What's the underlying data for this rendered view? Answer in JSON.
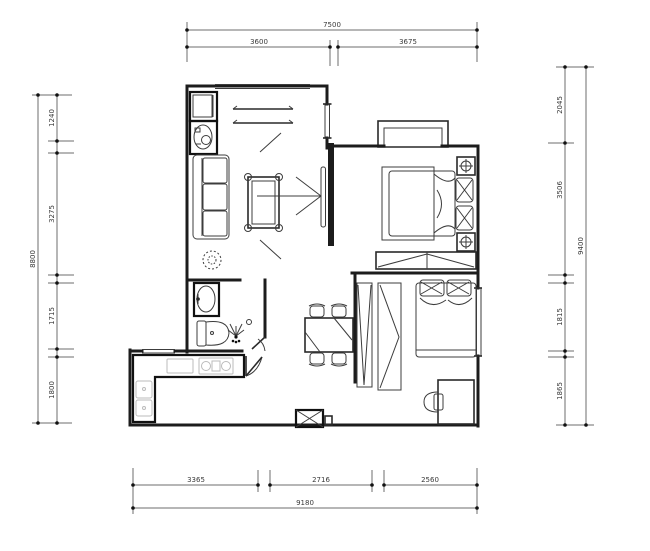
{
  "title": "apartment floor plan (CAD drawing)",
  "colors": {
    "background": "#ffffff",
    "wall_line": "#1c1c1c",
    "dimension_line": "#6e6e6e",
    "dimension_text": "#3a3a3a"
  },
  "dimensions": {
    "top": {
      "total": "7500",
      "segments": [
        "3600",
        "3675"
      ]
    },
    "bottom": {
      "total": "9180",
      "segments": [
        "3365",
        "2716",
        "2560"
      ]
    },
    "left": {
      "total": "8800",
      "segments": [
        "1240",
        "3275",
        "1715",
        "1800"
      ]
    },
    "right": {
      "total": "9400",
      "segments": [
        "2045",
        "3506",
        "1815",
        "1865"
      ]
    }
  },
  "symbols": [
    "washing-machine",
    "balcony-curtain-lines",
    "sofa",
    "coffee-table",
    "plant",
    "tv-wall-arrow",
    "tv-panel",
    "bay-window",
    "double-bed",
    "nightstand-lamp",
    "pillow",
    "wardrobe",
    "bathroom-sink",
    "toilet",
    "shower-head",
    "door-swing",
    "kitchen-counter",
    "kitchen-sink",
    "cooktop",
    "dining-table",
    "dining-chair",
    "single-bed",
    "desk",
    "desk-chair",
    "shaft-x-box",
    "window-double-line"
  ]
}
